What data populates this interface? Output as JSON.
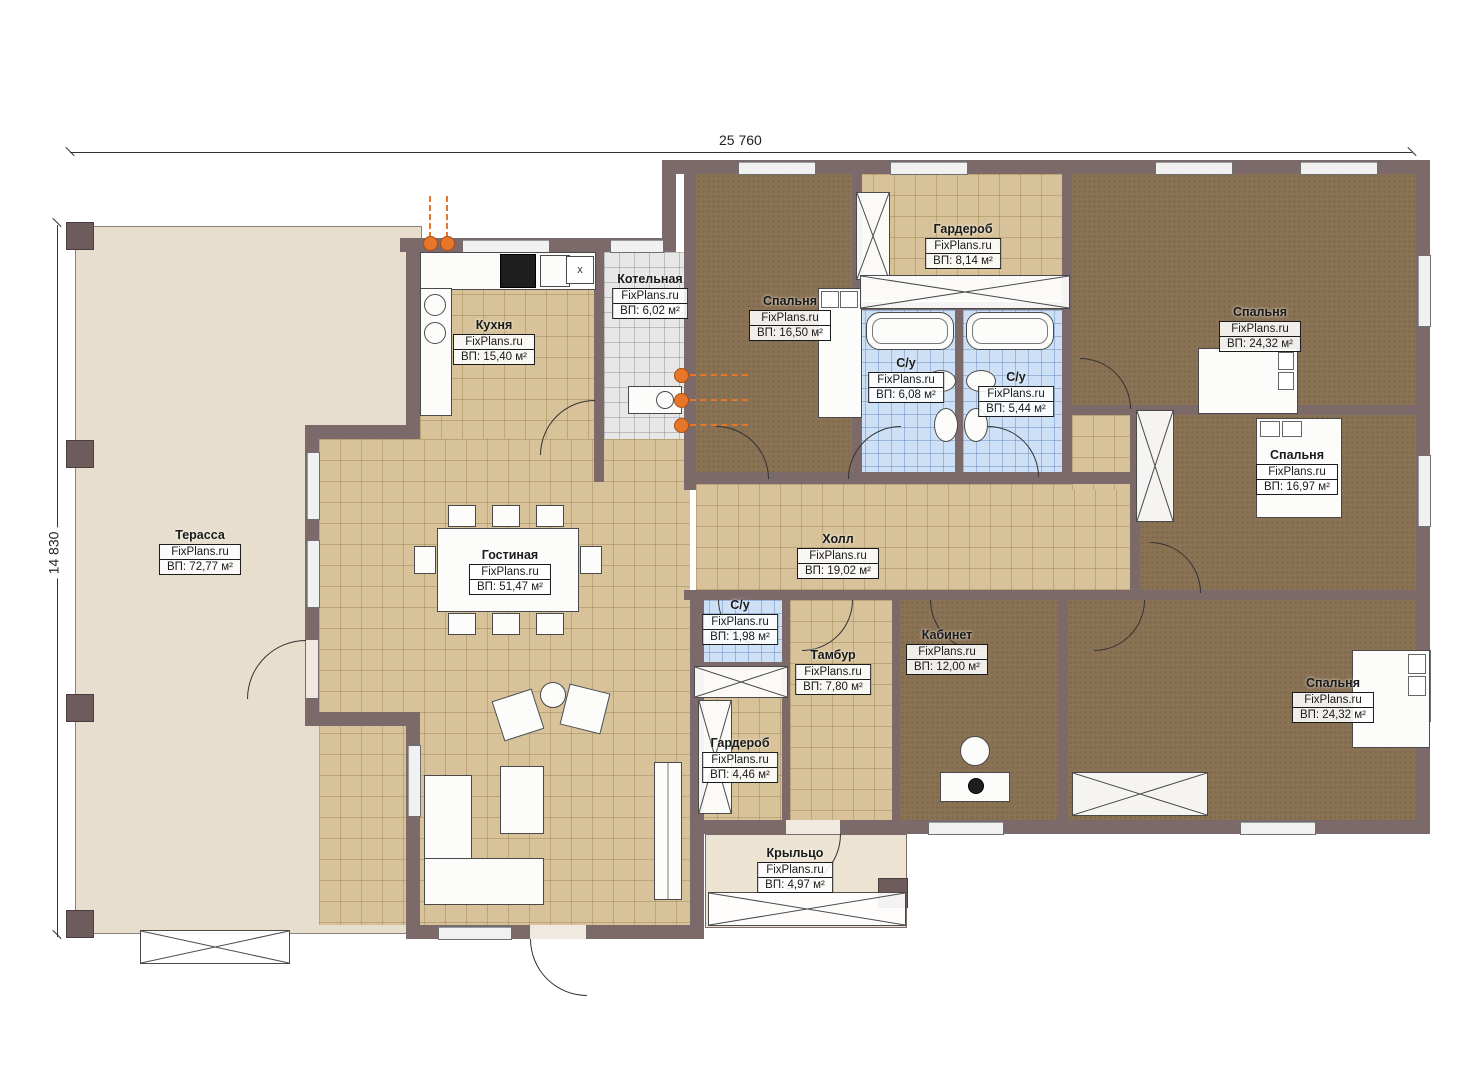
{
  "plan": {
    "brand": "FixPlans.ru",
    "dimensions": {
      "width_label": "25 760",
      "height_label": "14 830"
    },
    "markers": {
      "vent_label": "х"
    },
    "rooms": [
      {
        "name": "Терасса",
        "watermark": "FixPlans.ru",
        "area": "ВП: 72,77 м²"
      },
      {
        "name": "Кухня",
        "watermark": "FixPlans.ru",
        "area": "ВП: 15,40 м²"
      },
      {
        "name": "Котельная",
        "watermark": "FixPlans.ru",
        "area": "ВП: 6,02 м²"
      },
      {
        "name": "Спальня",
        "watermark": "FixPlans.ru",
        "area": "ВП: 16,50 м²"
      },
      {
        "name": "Гардероб",
        "watermark": "FixPlans.ru",
        "area": "ВП: 8,14 м²"
      },
      {
        "name": "С/у",
        "watermark": "FixPlans.ru",
        "area": "ВП: 6,08 м²"
      },
      {
        "name": "С/у",
        "watermark": "FixPlans.ru",
        "area": "ВП: 5,44 м²"
      },
      {
        "name": "Спальня",
        "watermark": "FixPlans.ru",
        "area": "ВП: 24,32 м²"
      },
      {
        "name": "Спальня",
        "watermark": "FixPlans.ru",
        "area": "ВП: 16,97 м²"
      },
      {
        "name": "Гостиная",
        "watermark": "FixPlans.ru",
        "area": "ВП: 51,47 м²"
      },
      {
        "name": "Холл",
        "watermark": "FixPlans.ru",
        "area": "ВП: 19,02 м²"
      },
      {
        "name": "С/у",
        "watermark": "FixPlans.ru",
        "area": "ВП: 1,98 м²"
      },
      {
        "name": "Тамбур",
        "watermark": "FixPlans.ru",
        "area": "ВП: 7,80 м²"
      },
      {
        "name": "Кабинет",
        "watermark": "FixPlans.ru",
        "area": "ВП: 12,00 м²"
      },
      {
        "name": "Гардероб",
        "watermark": "FixPlans.ru",
        "area": "ВП: 4,46 м²"
      },
      {
        "name": "Спальня",
        "watermark": "FixPlans.ru",
        "area": "ВП: 24,32 м²"
      },
      {
        "name": "Крыльцо",
        "watermark": "FixPlans.ru",
        "area": "ВП: 4,97 м²"
      }
    ],
    "colors": {
      "wall": "#7c6a6b",
      "tile_tan": "#d7c299",
      "carpet": "#8a7254",
      "tile_blue": "#cde0f5",
      "terrace": "#e7decd",
      "pipe_marker": "#e8762a"
    }
  }
}
